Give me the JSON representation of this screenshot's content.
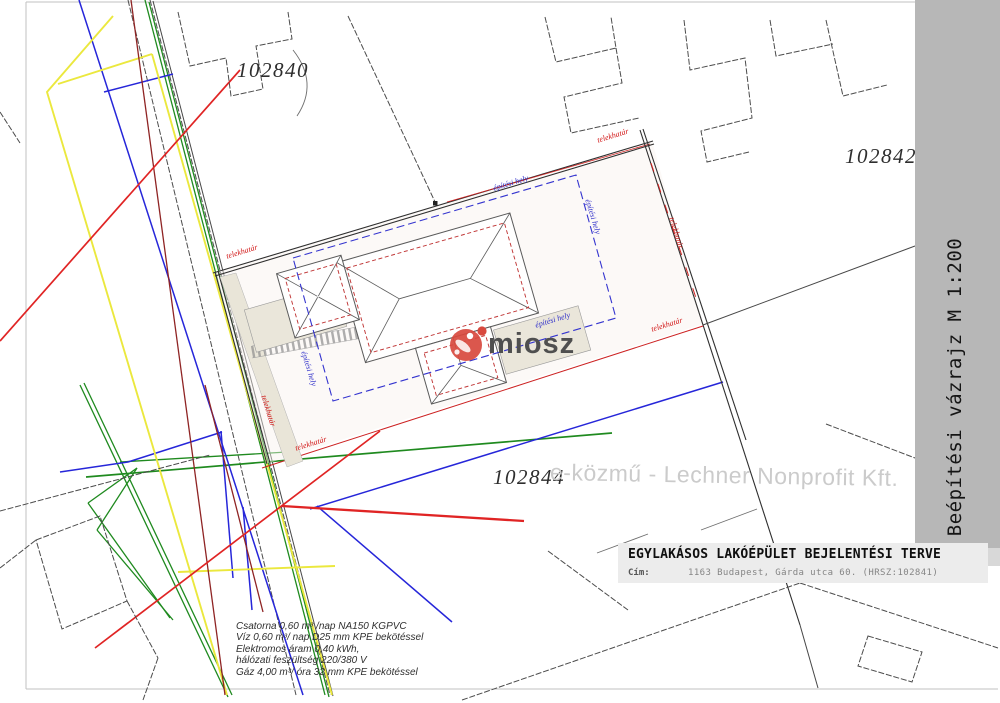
{
  "plan": {
    "parcels": {
      "left": "102840",
      "right": "102842",
      "bottom": "102844"
    },
    "boundary_label": "telekhatár",
    "building_zone_label": "építési hely"
  },
  "watermarks": {
    "logo_text": "miosz",
    "provider": "e-közmű - Lechner Nonprofit Kft."
  },
  "sidebar": {
    "title": "Beépítési vázrajz M 1:200"
  },
  "title_block": {
    "title": "EGYLAKÁSOS LAKÓÉPÜLET BEJELENTÉSI TERVE",
    "address_label": "Cím:",
    "address_value": "1163 Budapest, Gárda utca 60. (HRSZ:102841)"
  },
  "utilities_note": {
    "line1": "Csatorna 0,60 m³ /nap NA150 KGPVC",
    "line2": "Víz 0,60 m³/ nap D25 mm KPE bekötéssel",
    "line3": "Elektromos áram 0,40 kWh,",
    "line4": "hálózati feszültség 220/380 V",
    "line5": "Gáz 4,00 m³/ óra 32 mm KPE bekötéssel"
  },
  "colors": {
    "boundary_red": "#d22222",
    "building_zone_blue": "#3434cf",
    "building_wall_red": "#c03636",
    "utility_green": "#1f8a1f",
    "utility_blue": "#2626d9",
    "utility_yellow": "#ebe83e",
    "utility_red": "#e02424",
    "utility_dark_red": "#8f2424",
    "sidebar_gray": "#b7b7b7",
    "title_block_gray": "#ececec",
    "logo_red": "#d8493e",
    "watermark_gray": "#cbcbcb"
  }
}
